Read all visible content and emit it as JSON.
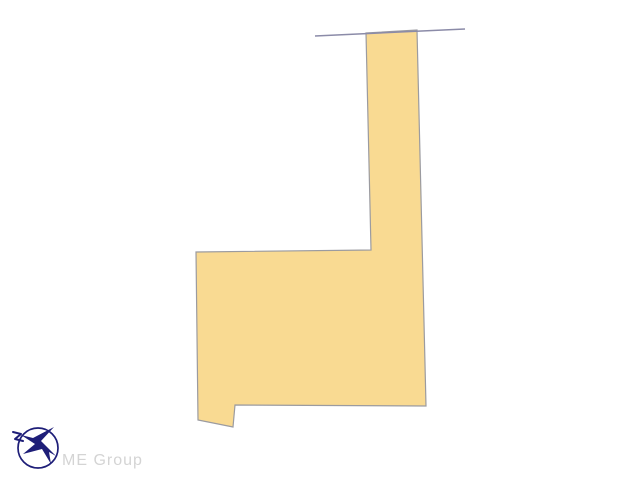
{
  "page": {
    "background": "#ffffff",
    "title": "land-parcel-plot-diagram"
  },
  "diagram": {
    "kind": "real-estate land parcel outline (flag-shaped lot)",
    "parcel": {
      "points": "366,33 417,30 426,406 235,405 233,427 198,420 196,252 371,250",
      "fill": "#f9da92",
      "stroke": "#9b9ba0",
      "stroke_width": "1.2"
    },
    "road_line": {
      "x1": "315",
      "y1": "36",
      "x2": "465",
      "y2": "29",
      "color": "#8b8ba8",
      "width": "1.5"
    }
  },
  "logo": {
    "brand_text": "ME Group",
    "icon_color": "#1e1e78",
    "circle_color": "#1e1e78",
    "text_color": "#d4d4d4"
  }
}
